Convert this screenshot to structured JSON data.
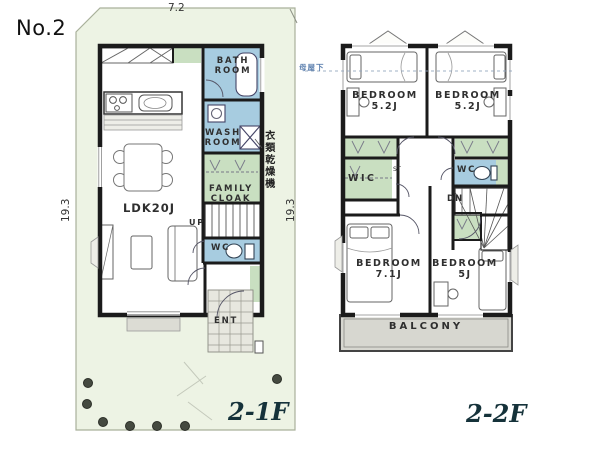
{
  "title": "No.2",
  "colors": {
    "lot": "#edf3e4",
    "wet": "#a7cce0",
    "closet": "#c9dfc1",
    "balcony": "#d7d7d0",
    "tile": "#e7e7df",
    "wall": "#1b1b1b"
  },
  "floor1": {
    "label": "2-1F",
    "dim_top": "7.2",
    "dim_left": "19.3",
    "dim_right": "19.3",
    "bath": "BATH ROOM",
    "wash": "WASH ROOM",
    "dryer_note": "衣類乾燥機",
    "family_cloak": "FAMILY CLOAK",
    "ldk": "LDK20J",
    "up": "UP",
    "wc": "WC",
    "ent": "ENT"
  },
  "floor2": {
    "label": "2-2F",
    "roof_note": "母屋下",
    "bedroom_tl": {
      "name": "BEDROOM",
      "size": "5.2J"
    },
    "bedroom_tr": {
      "name": "BEDROOM",
      "size": "5.2J"
    },
    "bedroom_bl": {
      "name": "BEDROOM",
      "size": "7.1J"
    },
    "bedroom_br": {
      "name": "BEDROOM",
      "size": "5J"
    },
    "wic": "WIC",
    "st": "ST",
    "wc": "WC",
    "dn": "DN",
    "balcony": "BALCONY"
  }
}
